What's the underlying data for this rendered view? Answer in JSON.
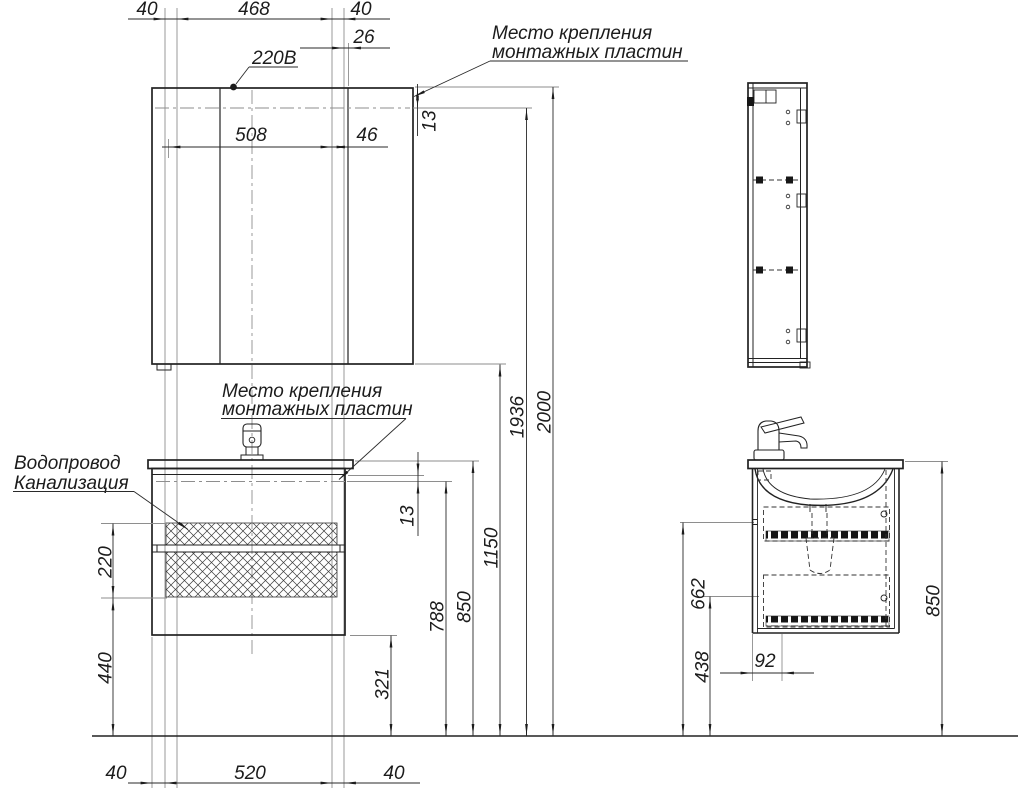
{
  "colors": {
    "background": "#ffffff",
    "outline": "#222222",
    "thin_line": "#8e8e8e",
    "text": "#1c1c1c",
    "hatch": "#3c3c3c"
  },
  "labels": {
    "voltage": "220В",
    "mounting_plates_top": {
      "line1": "Место крепления",
      "line2": "монтажных пластин"
    },
    "mounting_plates_mid": {
      "line1": "Место крепления",
      "line2": "монтажных пластин"
    },
    "plumbing": {
      "line1": "Водопровод",
      "line2": "Канализация"
    }
  },
  "dimensions": {
    "front_top": {
      "left_offset": "40",
      "center_span": "468",
      "right_offset": "40",
      "door_offset": "26",
      "mirror_span": "508",
      "door_gap": "46",
      "plate_inset": "13"
    },
    "front_right": {
      "plate_height": "788",
      "counter_height": "850",
      "mirror_bottom": "1150",
      "mirror_plate": "1936",
      "total_height": "2000",
      "vanity_plate_inset": "13"
    },
    "front_left": {
      "hatch_height": "220",
      "hatch_floor": "440"
    },
    "front_bottom": {
      "left_offset": "40",
      "span": "520",
      "right_offset": "40",
      "vanity_floor": "321"
    },
    "side": {
      "drawer_gap_height": "662",
      "lower_height": "438",
      "front_depth": "92",
      "total": "850"
    }
  }
}
